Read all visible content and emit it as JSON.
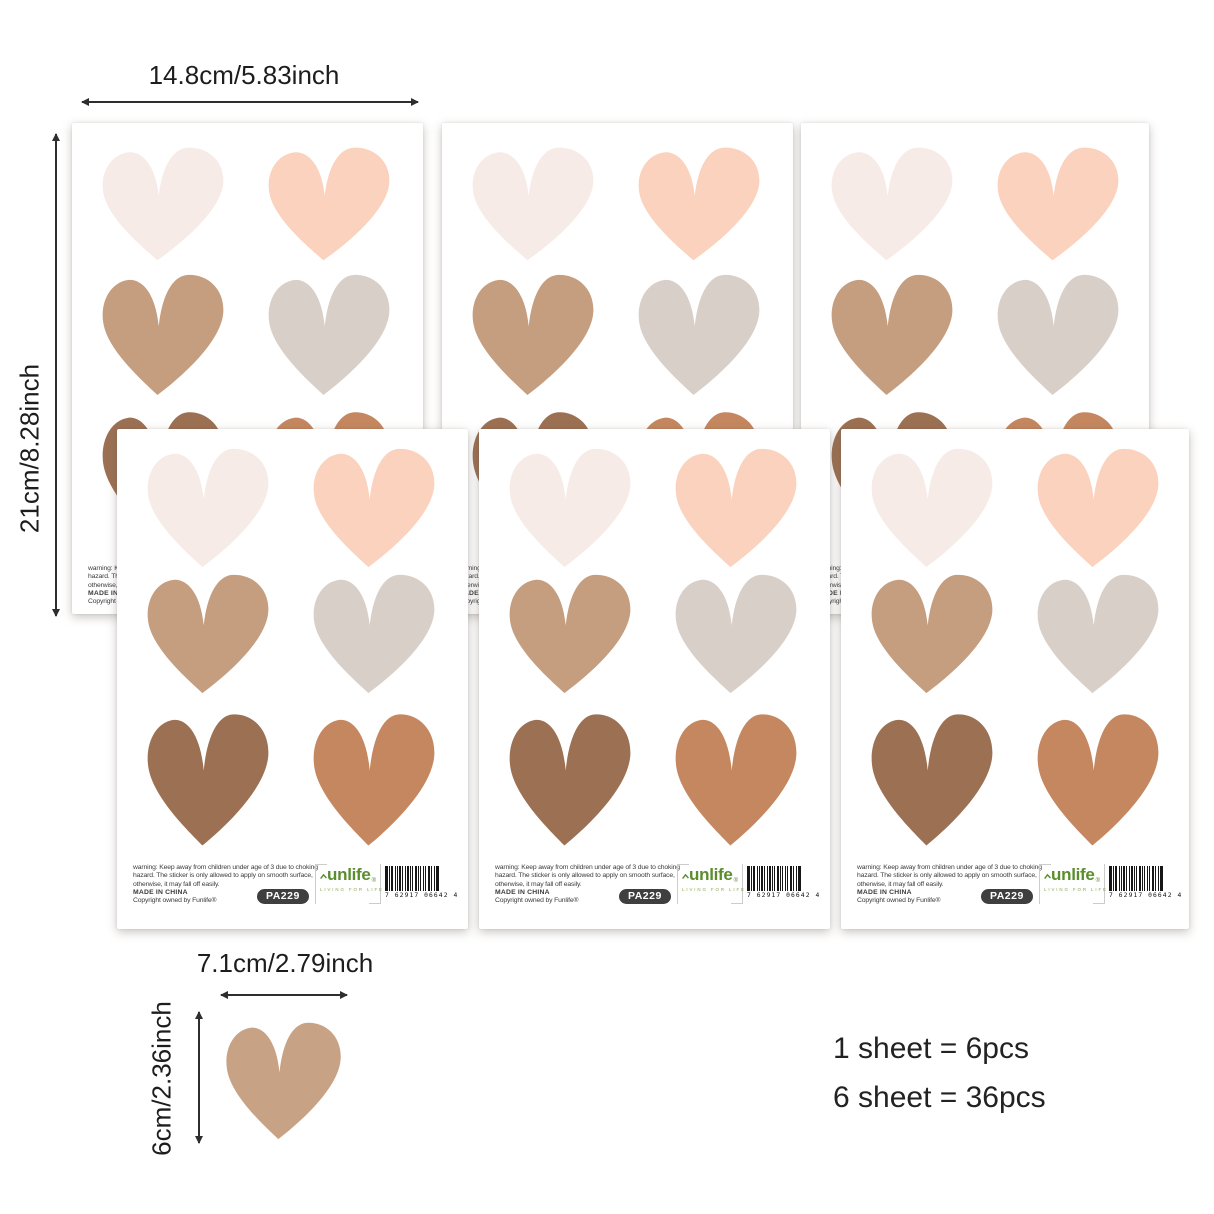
{
  "dims": {
    "sheet_width": "14.8cm/5.83inch",
    "sheet_height": "21cm/8.28inch",
    "heart_width": "7.1cm/2.79inch",
    "heart_height": "6cm/2.36inch"
  },
  "counts": {
    "line1": "1 sheet = 6pcs",
    "line2": "6 sheet = 36pcs"
  },
  "sheet": {
    "warning1": "warning: Keep away from children under age of 3 due to choking",
    "warning2": "hazard. The sticker is only allowed to apply on smooth surface,",
    "warning3": "otherwise, it may fall off easily.",
    "made_in": "MADE IN CHINA",
    "copyright": "Copyright owned by Funlife®",
    "sku": "PA229",
    "logo_text": "unlife",
    "logo_reg": "®",
    "logo_tagline": "LIVING FOR LIFE",
    "barcode_digits": "7 62917 06642 4"
  },
  "hearts": {
    "colors": [
      {
        "name": "blush",
        "hex": "#f7ebe7"
      },
      {
        "name": "peach",
        "hex": "#fad2bd"
      },
      {
        "name": "tan",
        "hex": "#c59d7f"
      },
      {
        "name": "greige",
        "hex": "#d9cfc9"
      },
      {
        "name": "brown",
        "hex": "#9c7053"
      },
      {
        "name": "terracotta",
        "hex": "#c5875f"
      }
    ],
    "single_hex": "#c8a284",
    "logo_green": "#5a8e2c"
  }
}
